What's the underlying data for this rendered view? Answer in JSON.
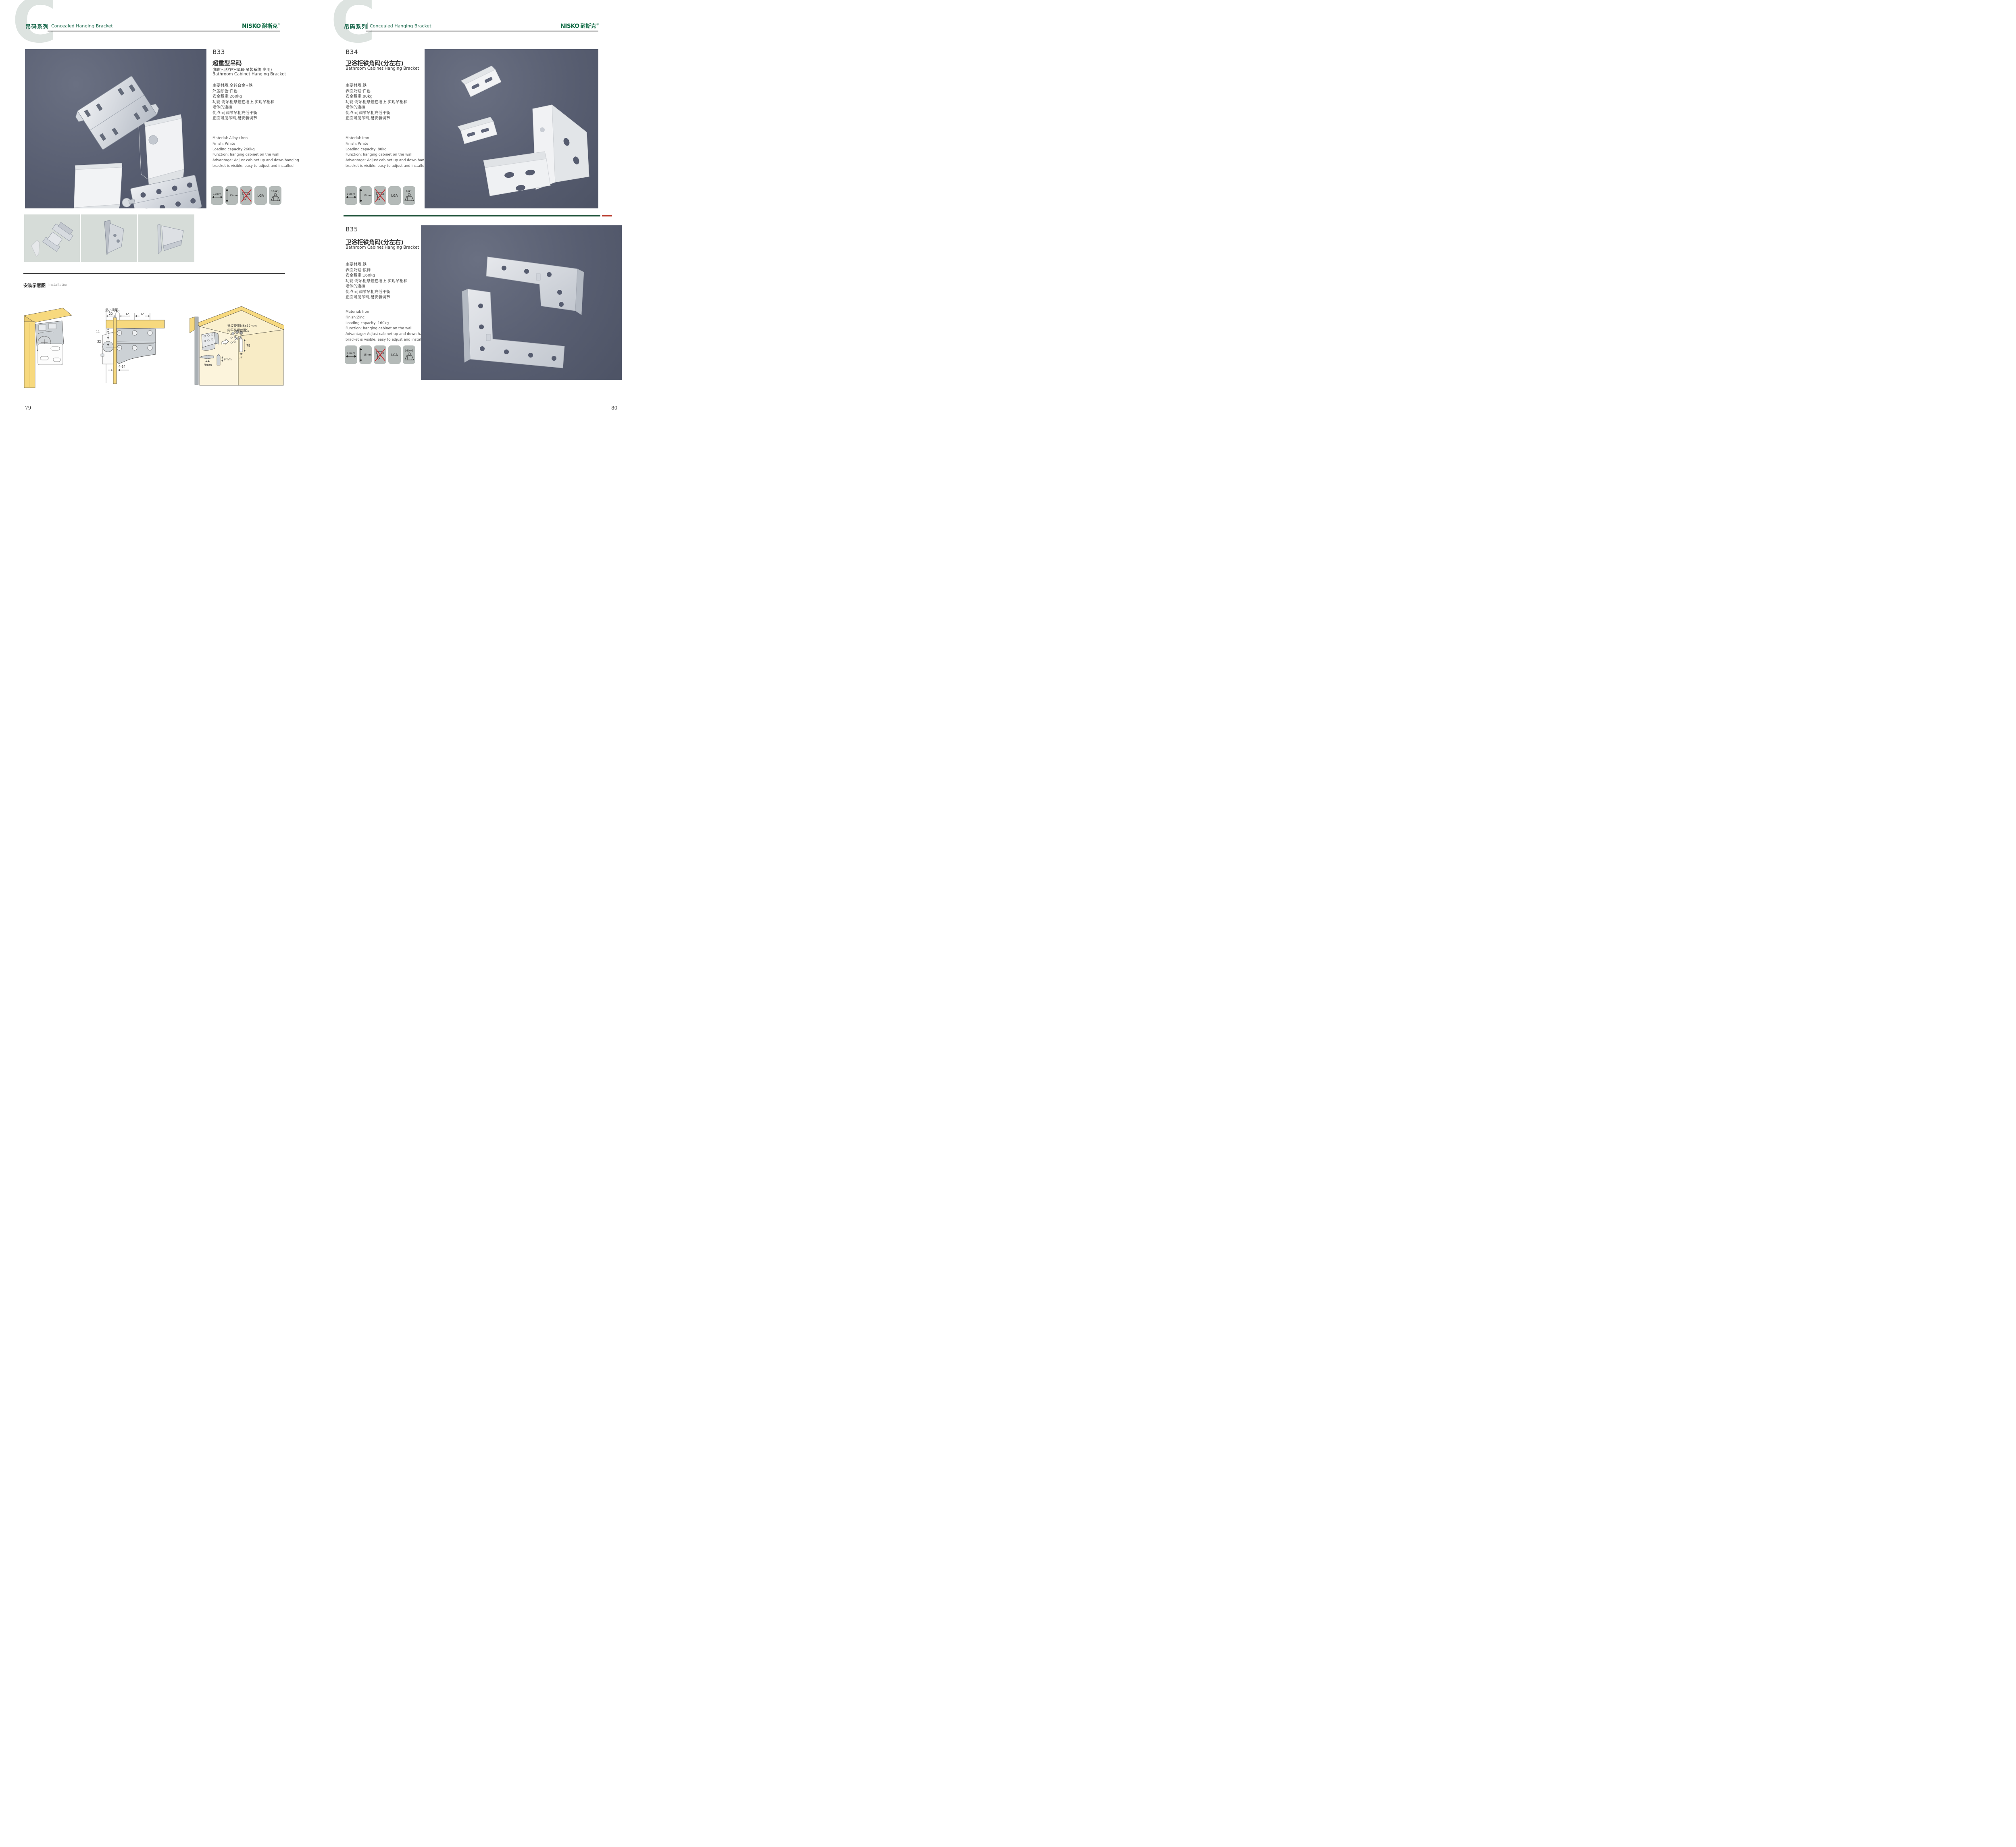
{
  "header": {
    "watermark": "C",
    "series_cn": "吊码系列",
    "series_en": "Concealed Hanging Bracket"
  },
  "brand": {
    "en": "NISKO",
    "cn": "耐斯克",
    "reg": "®"
  },
  "colors": {
    "accent_green": "#17664a",
    "logo_green": "#0d6a43",
    "separator_green": "#1c5138",
    "separator_red": "#b8392b",
    "photo_background": "#585e71",
    "thumbnail_background": "#d6dcd8",
    "icon_tile": "#b4bab8",
    "wood_yellow": "#f7d97e",
    "wood_light": "#f9eec9"
  },
  "products": [
    {
      "code": "B33",
      "title_cn": "超重型吊码",
      "subtitle_cn": "(橱柜·卫浴柜·家具·吊装系统 专用)",
      "title_en": "Bathroom Cabinet Hanging Bracket",
      "specs_cn": "主要材质:全锌合金+铁\n外盖颜色:白色\n安全载重:260kg\n功能:将吊柜悬挂在墙上,实现吊柜和\n墙体的连接\n优点:可调节吊柜高低平衡\n正面可见吊码,易安装调节",
      "specs_en": "Material: Alloy+iron\nFinish: White\nLoading capacity:260kg\nFunction: hanging cabinet on the wall\nAdvantage: Adjust cabinet up and down hanging\nbracket is visible, easy to adjust and installed",
      "icons": {
        "width": "12mm",
        "height": "13mm",
        "cert": "LGA",
        "load": "260Kg"
      }
    },
    {
      "code": "B34",
      "title_cn": "卫浴柜铁角码(分左右)",
      "title_en": "Bathroom Cabinet Hanging Bracket",
      "specs_cn": "主要材质:铁\n表面处理:白色\n安全载重:80kg\n功能:将吊柜悬挂在墙上,实现吊柜和\n墙体的连接\n优点:可调节吊柜高低平衡\n正面可见吊码,易安装调节",
      "specs_en": "Material: Iron\nFinish: White\nLoading capacity: 80kg\nFunction: hanging cabinet on the wall\nAdvantage: Adjust cabinet up and down hanging\nbracket is visible, easy to adjust and installed",
      "icons": {
        "width": "10mm",
        "height": "15mm",
        "cert": "LGA",
        "load": "80Kg"
      }
    },
    {
      "code": "B35",
      "title_cn": "卫浴柜铁角码(分左右)",
      "title_en": "Bathroom Cabinet Hanging Bracket",
      "specs_cn": "主要材质:铁\n表面处理:镀锌\n安全载重:160kg\n功能:将吊柜悬挂在墙上,实现吊柜和\n墙体的连接\n优点:可调节吊柜高低平衡\n正面可见吊码,易安装调节",
      "specs_en": "Material: Iron\nFinish:Zinc\nLoading capacity: 160kg\nFunction: hanging cabinet on the wall\nAdvantage: Adjust cabinet up and down hanging\nbracket is visible, easy to adjust and installed",
      "icons": {
        "width": "10mm",
        "height": "15mm",
        "cert": "LGA",
        "load": "160KG"
      }
    }
  ],
  "installation": {
    "title_cn": "安装示意图",
    "title_en": "Installation",
    "min_gap_label": "最小间距",
    "dim_top_1": "20",
    "dim_top_2": "10",
    "dim_top_3": "32",
    "dim_top_4": "32",
    "dim_left_1": "11",
    "dim_left_2": "32",
    "dim_bottom": "4-14",
    "screw_note_1": "建议使用M6x12mm",
    "screw_note_2": "的平头螺丝固定",
    "dim_height": "78",
    "dim_width": "37",
    "bit_width": "9mm",
    "bit_height": "9mm"
  },
  "pages": {
    "left_number": "79",
    "right_number": "80"
  }
}
